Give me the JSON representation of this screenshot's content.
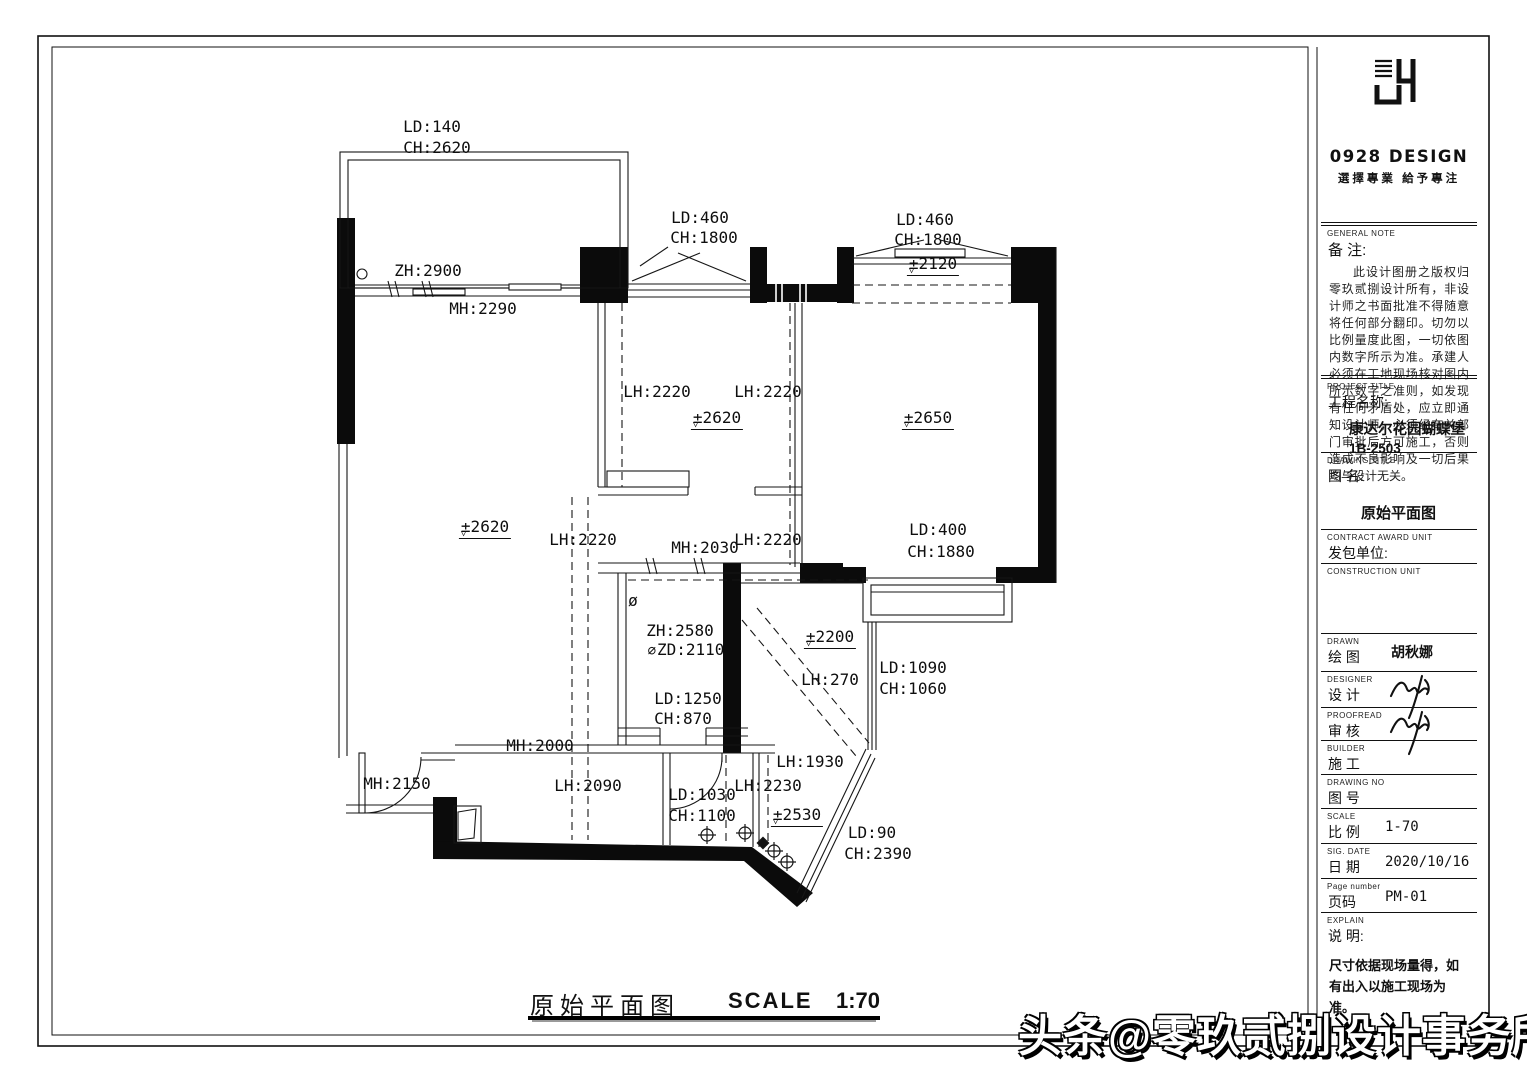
{
  "title_block": {
    "logo": {
      "brand": "0928 DESIGN",
      "slogan": "選擇專業 給予專注"
    },
    "general_note": {
      "label_en": "GENERAL NOTE",
      "label_cn": "备 注:",
      "text": "此设计图册之版权归零玖贰捌设计所有，非设计师之书面批准不得随意将任何部分翻印。切勿以比例量度此图，一切依图内数字所示为准。承建人必须在工地现场核对图内所示数字之准则，如发现有任何矛盾处，应立即通知设计师，必须经有关部门审批后方可施工，否则造成不良影响及一切后果均与设计无关。"
    },
    "project": {
      "label_en": "PROJECT TITLE",
      "label_cn": "工程名称:",
      "name": "康达尔花园蝴蝶堡",
      "unit": "1B-2503"
    },
    "drawing": {
      "label_en": "DRAWING TITLE",
      "label_cn": "图 名:",
      "name": "原始平面图"
    },
    "contract": {
      "label_en": "CONTRACT AWARD UNIT",
      "label_cn": "发包单位:"
    },
    "construction": {
      "label_en": "CONSTRUCTION UNIT"
    },
    "rows": [
      {
        "en": "DRAWN",
        "cn": "绘 图",
        "value": "胡秋娜",
        "value_cjk": true,
        "signature": false
      },
      {
        "en": "DESIGNER",
        "cn": "设 计",
        "value": "",
        "signature": true
      },
      {
        "en": "PROOFREAD",
        "cn": "审 核",
        "value": "",
        "signature": true
      },
      {
        "en": "BUILDER",
        "cn": "施 工",
        "value": "",
        "signature": false
      },
      {
        "en": "DRAWING NO",
        "cn": "图 号",
        "value": "",
        "signature": false
      },
      {
        "en": "SCALE",
        "cn": "比 例",
        "value": "1-70",
        "signature": false
      },
      {
        "en": "SIG. DATE",
        "cn": "日 期",
        "value": "2020/10/16",
        "signature": false
      },
      {
        "en": "Page number",
        "cn": "页码",
        "value": "PM-01",
        "signature": false
      }
    ],
    "explain": {
      "label_en": "EXPLAIN",
      "label_cn": "说 明:",
      "text": "尺寸依据现场量得，如\n有出入以施工现场为准。"
    }
  },
  "footer": {
    "title": "原始平面图",
    "scale_label": "SCALE",
    "scale_value": "1:70"
  },
  "watermark": "头条@零玖贰捌设计事务所",
  "plan": {
    "labels": [
      {
        "t": "LD:140",
        "x": 432,
        "y": 127
      },
      {
        "t": "CH:2620",
        "x": 437,
        "y": 148
      },
      {
        "t": "ZH:2900",
        "x": 428,
        "y": 271
      },
      {
        "t": "MH:2290",
        "x": 483,
        "y": 309
      },
      {
        "t": "LD:460",
        "x": 700,
        "y": 218
      },
      {
        "t": "CH:1800",
        "x": 704,
        "y": 238
      },
      {
        "t": "LD:460",
        "x": 925,
        "y": 220
      },
      {
        "t": "CH:1800",
        "x": 928,
        "y": 240
      },
      {
        "t": "±2120",
        "x": 933,
        "y": 266,
        "lvl": true
      },
      {
        "t": "LH:2220",
        "x": 657,
        "y": 392
      },
      {
        "t": "LH:2220",
        "x": 768,
        "y": 392
      },
      {
        "t": "±2620",
        "x": 717,
        "y": 420,
        "lvl": true
      },
      {
        "t": "±2650",
        "x": 928,
        "y": 420,
        "lvl": true
      },
      {
        "t": "±2620",
        "x": 485,
        "y": 529,
        "lvl": true
      },
      {
        "t": "LH:2220",
        "x": 583,
        "y": 540
      },
      {
        "t": "MH:2030",
        "x": 705,
        "y": 548
      },
      {
        "t": "LH:2220",
        "x": 768,
        "y": 540
      },
      {
        "t": "LD:400",
        "x": 938,
        "y": 530
      },
      {
        "t": "CH:1880",
        "x": 941,
        "y": 552
      },
      {
        "t": "ZH:2580",
        "x": 680,
        "y": 631
      },
      {
        "t": "ZD:2110",
        "x": 686,
        "y": 650,
        "prefix": "⌀"
      },
      {
        "t": "±2200",
        "x": 830,
        "y": 639,
        "lvl": true
      },
      {
        "t": "LH:270",
        "x": 830,
        "y": 680
      },
      {
        "t": "LD:1090",
        "x": 913,
        "y": 668
      },
      {
        "t": "CH:1060",
        "x": 913,
        "y": 689
      },
      {
        "t": "LD:1250",
        "x": 688,
        "y": 699
      },
      {
        "t": "CH:870",
        "x": 683,
        "y": 719
      },
      {
        "t": "ø",
        "x": 633,
        "y": 601
      },
      {
        "t": "MH:2000",
        "x": 540,
        "y": 746
      },
      {
        "t": "MH:2150",
        "x": 397,
        "y": 784
      },
      {
        "t": "LH:2090",
        "x": 588,
        "y": 786
      },
      {
        "t": "LD:1030",
        "x": 702,
        "y": 795
      },
      {
        "t": "CH:1100",
        "x": 702,
        "y": 816
      },
      {
        "t": "LH:2230",
        "x": 768,
        "y": 786
      },
      {
        "t": "LH:1930",
        "x": 810,
        "y": 762
      },
      {
        "t": "±2530",
        "x": 797,
        "y": 817,
        "lvl": true
      },
      {
        "t": "LD:90",
        "x": 872,
        "y": 833
      },
      {
        "t": "CH:2390",
        "x": 878,
        "y": 854
      }
    ]
  }
}
